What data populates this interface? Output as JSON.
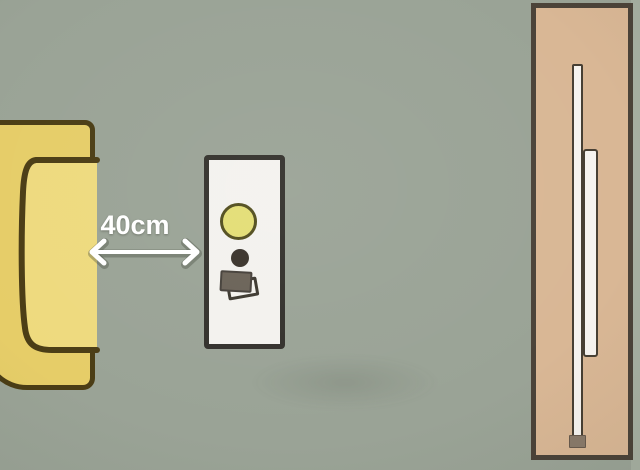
{
  "diagram": {
    "type": "top-view furniture spacing illustration",
    "distance_label": "40cm",
    "measurement": {
      "value": "40cm",
      "from": "bed",
      "to": "nightstand"
    },
    "objects": [
      {
        "name": "bed",
        "description": "yellow bed/sofa seen from above, extends off the left edge, dark outline, curved seat line"
      },
      {
        "name": "nightstand",
        "description": "white side table holding a round table lamp, a small dark cup and two stacked books"
      },
      {
        "name": "wardrobe",
        "description": "tan wardrobe/wall panel on the right with overlapping white sliding-door panels and a small handle cap"
      }
    ]
  },
  "colors": {
    "bg": "#9aa396",
    "bg_edge_right": "#a6afa1",
    "bed_fill": "#e6cd68",
    "bed_seat_fill": "#eeda7e",
    "bed_outline": "#4b3d15",
    "table_fill": "#f3f2ee",
    "table_outline": "#33312c",
    "lamp_fill": "#e3de75",
    "lamp_outline": "#514d1d",
    "cup_fill": "#39332b",
    "book_fill": "#6a6257",
    "book_outline": "#45403a",
    "paper_outline": "#3c382f",
    "wardrobe_fill": "#d9b795",
    "wardrobe_outline": "#4b4339",
    "door_fill": "#f6f3ef",
    "door_outline": "#473f33",
    "handle_fill": "#8a7a6a",
    "arrow_color": "#ffffff",
    "arrow_shadow": "rgba(60,66,55,0.35)"
  }
}
